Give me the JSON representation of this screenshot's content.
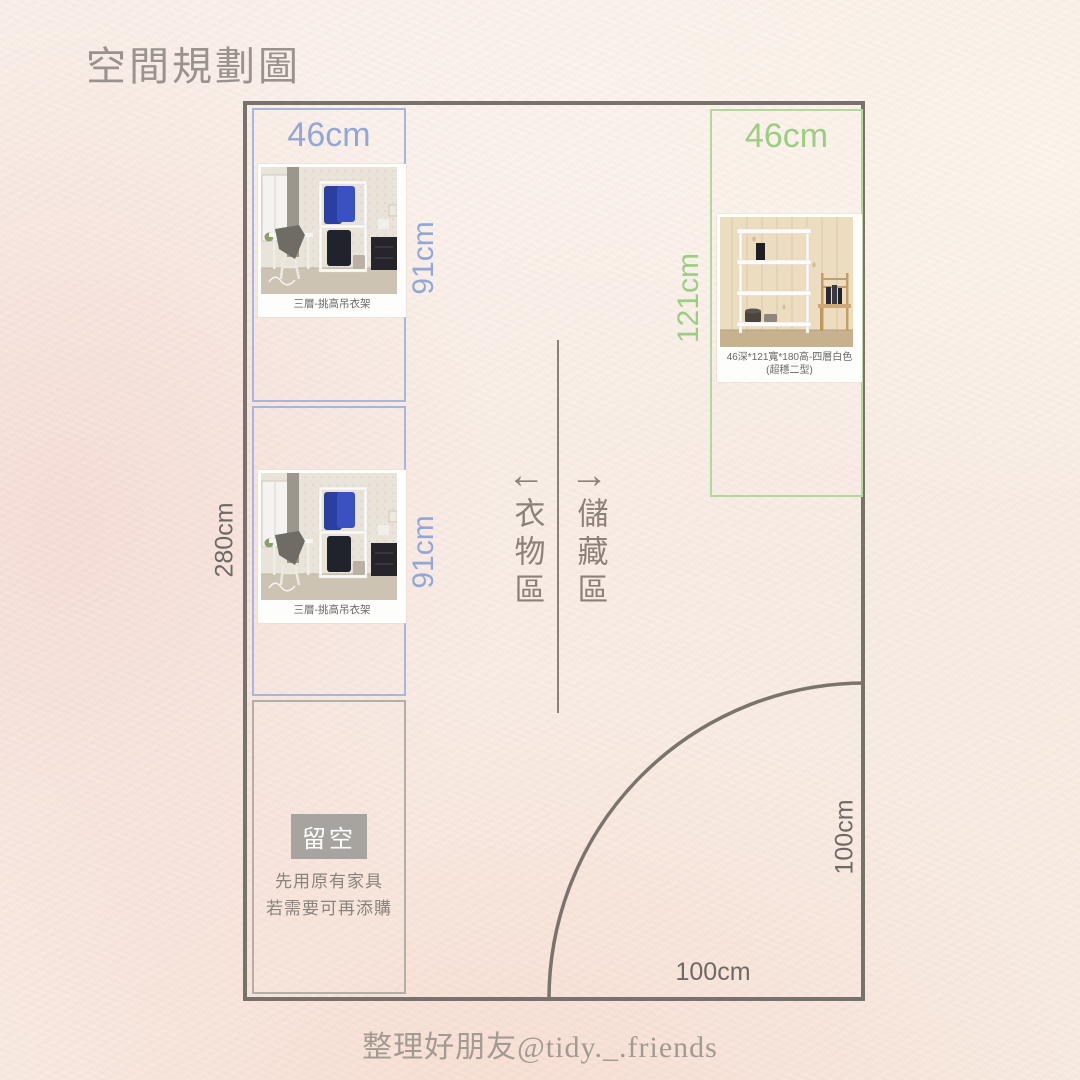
{
  "page": {
    "title": "空間規劃圖",
    "footer_credit": "整理好朋友@tidy._.friends"
  },
  "room": {
    "height_label": "280cm",
    "door_swing": {
      "bottom_label": "100cm",
      "side_label": "100cm"
    }
  },
  "zone_divider": {
    "left_arrow": "←",
    "right_arrow": "→",
    "left_zone_label": "衣物區",
    "right_zone_label": "儲藏區"
  },
  "clothing_rack_top": {
    "width_label": "46cm",
    "height_label": "91cm",
    "caption": "三層-挑高吊衣架"
  },
  "clothing_rack_bottom": {
    "height_label": "91cm",
    "caption": "三層-挑高吊衣架"
  },
  "empty_space": {
    "badge": "留空",
    "note_line1": "先用原有家具",
    "note_line2": "若需要可再添購"
  },
  "storage_shelf": {
    "width_label": "46cm",
    "height_label": "121cm",
    "caption": "46深*121寬*180高-四層白色(超穩二型)"
  },
  "colors": {
    "clothing_accent": "#93a7d7",
    "storage_accent": "#9ccd83",
    "room_outline": "#78726c",
    "dimension_text": "#6e6965",
    "zone_text": "#8c8177"
  }
}
